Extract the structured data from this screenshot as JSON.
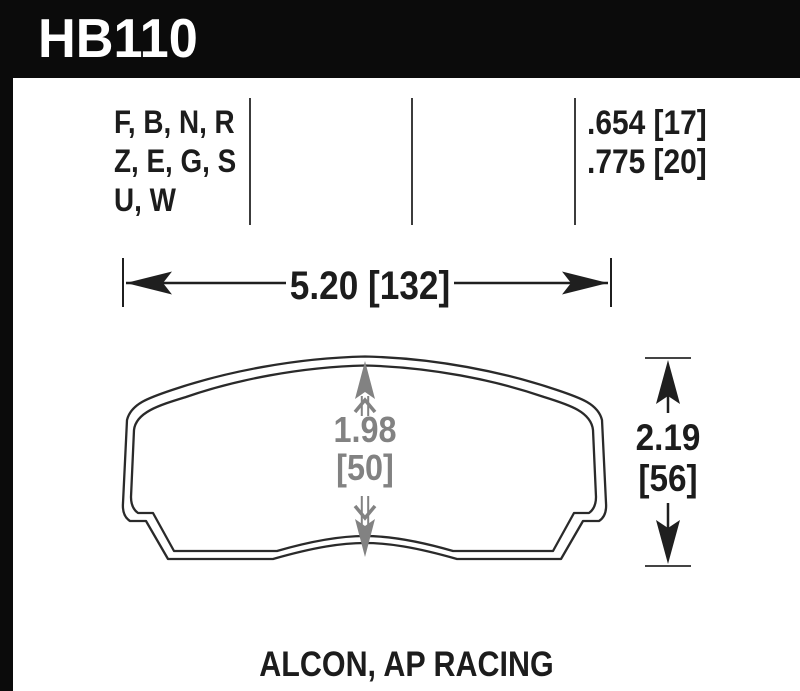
{
  "part": {
    "number": "HB110"
  },
  "table": {
    "compounds": [
      "F, B, N, R",
      "Z, E, G, S",
      "U, W"
    ],
    "thicknesses": [
      ".654 [17]",
      ".775 [20]"
    ]
  },
  "dimensions": {
    "width": "5.20 [132]",
    "height_in": "2.19",
    "height_mm": "[56]",
    "depth_in": "1.98",
    "depth_mm": "[50]"
  },
  "footer": {
    "applications": "ALCON, AP RACING"
  },
  "colors": {
    "header_bg": "#0b0b0b",
    "ink": "#1c1c1c",
    "dimension_gray": "#828282"
  }
}
